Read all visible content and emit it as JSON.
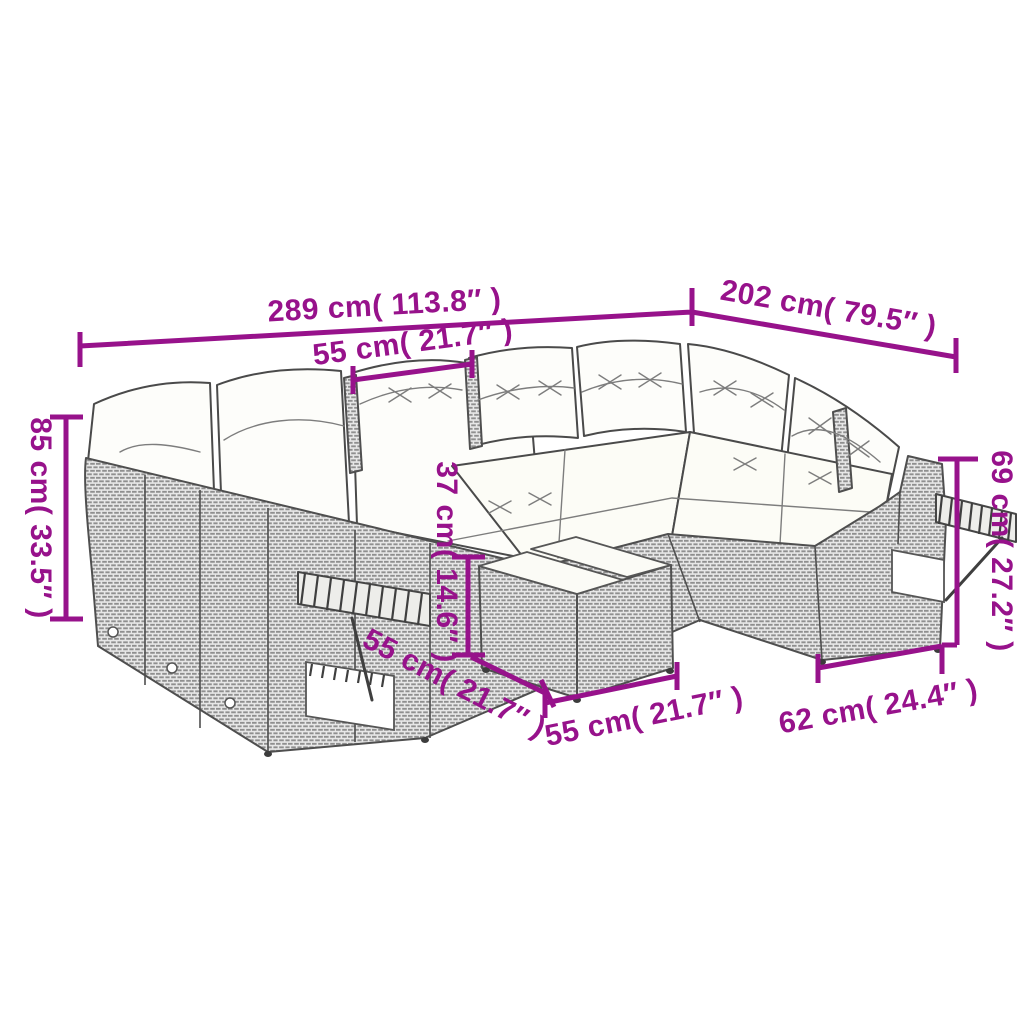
{
  "diagram": {
    "colors": {
      "dimension_accent": "#97128B",
      "line_art": "#4f4f4f",
      "cushion": "#fdfdfa",
      "background": "#ffffff"
    },
    "labels": {
      "overall_width": "289 cm( 113.8″ )",
      "overall_depth": "202 cm( 79.5″ )",
      "seat_module_width": "55 cm( 21.7″ )",
      "back_height": "85 cm( 33.5″ )",
      "arm_height": "69 cm( 27.2″ )",
      "seat_height": "37 cm( 14.6″ )",
      "table_depth": "55 cm( 21.7″ )",
      "table_width": "55 cm( 21.7″ )",
      "end_section_depth": "62 cm( 24.4″ )"
    }
  }
}
